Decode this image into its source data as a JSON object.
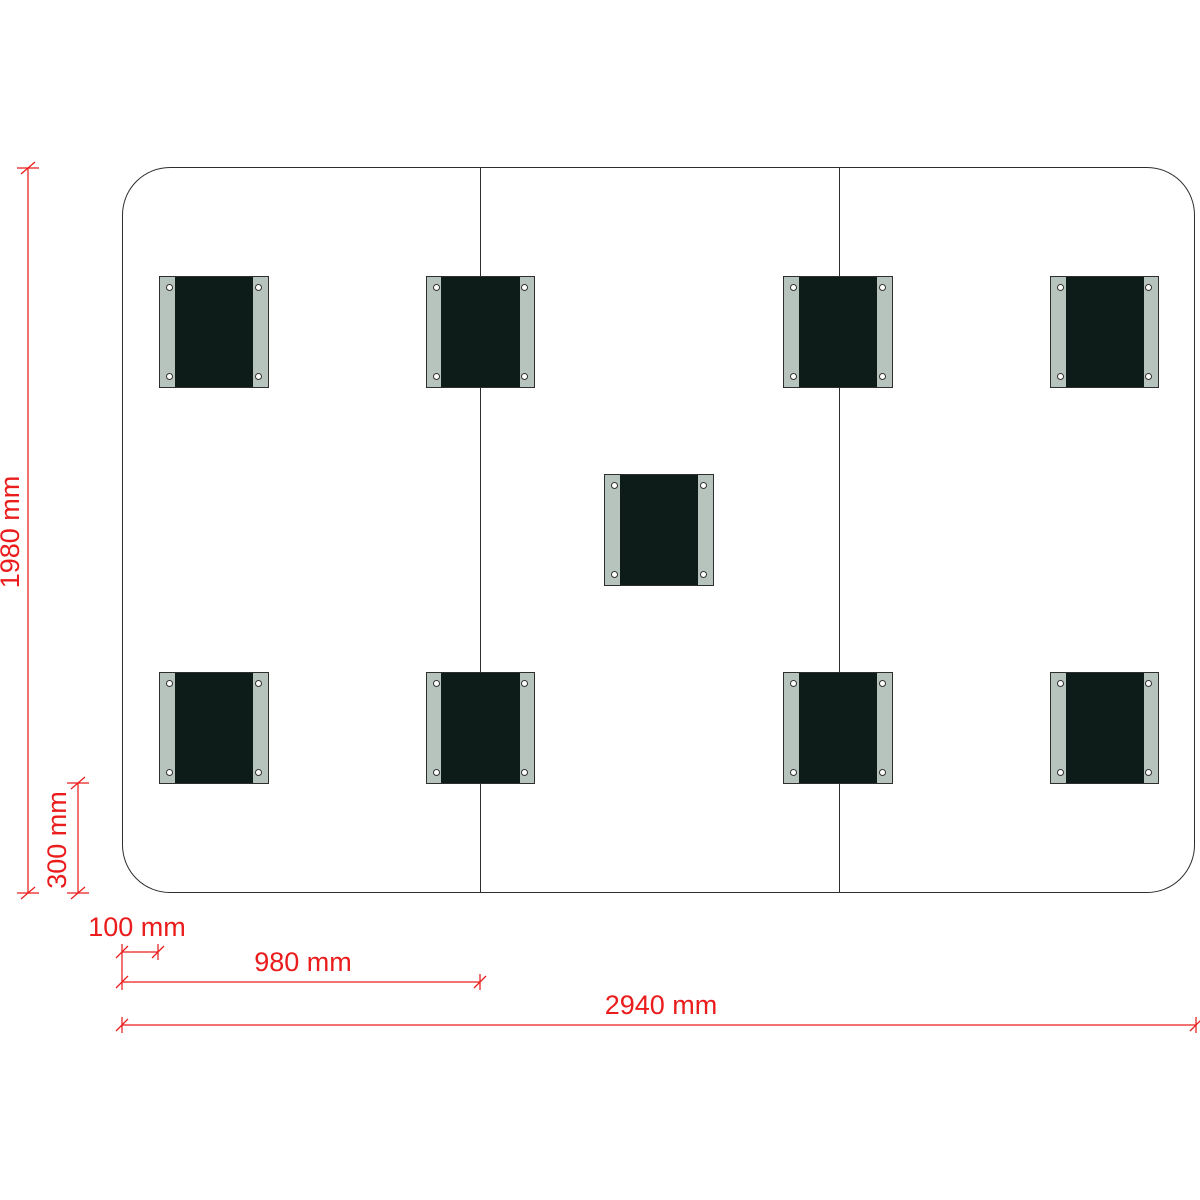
{
  "diagram": {
    "type": "technical-dimension-drawing",
    "unit": "mm",
    "panel": {
      "width_mm": 2940,
      "height_mm": 1980,
      "sections": 3,
      "section_width_mm": 980,
      "pad_count": 9
    },
    "dimensions": {
      "height": "1980 mm",
      "pad_bottom_offset": "300 mm",
      "pad_edge_offset": "100 mm",
      "section_width": "980 mm",
      "total_width": "2940 mm"
    },
    "pads": {
      "size_mm": {
        "width": 300,
        "height": 306
      },
      "rail_width_mm": 40,
      "items": [
        {
          "cx_mm": 250,
          "cy_mm": 450
        },
        {
          "cx_mm": 980,
          "cy_mm": 450
        },
        {
          "cx_mm": 1960,
          "cy_mm": 450
        },
        {
          "cx_mm": 2690,
          "cy_mm": 450
        },
        {
          "cx_mm": 1470,
          "cy_mm": 990
        },
        {
          "cx_mm": 250,
          "cy_mm": 1530
        },
        {
          "cx_mm": 980,
          "cy_mm": 1530
        },
        {
          "cx_mm": 1960,
          "cy_mm": 1530
        },
        {
          "cx_mm": 2690,
          "cy_mm": 1530
        }
      ]
    },
    "colors": {
      "dimension_red": "#ea1c1c",
      "pad_face": "#0d1b19",
      "pad_rail": "#b7c3bd",
      "outline": "#2e2e2e"
    }
  }
}
